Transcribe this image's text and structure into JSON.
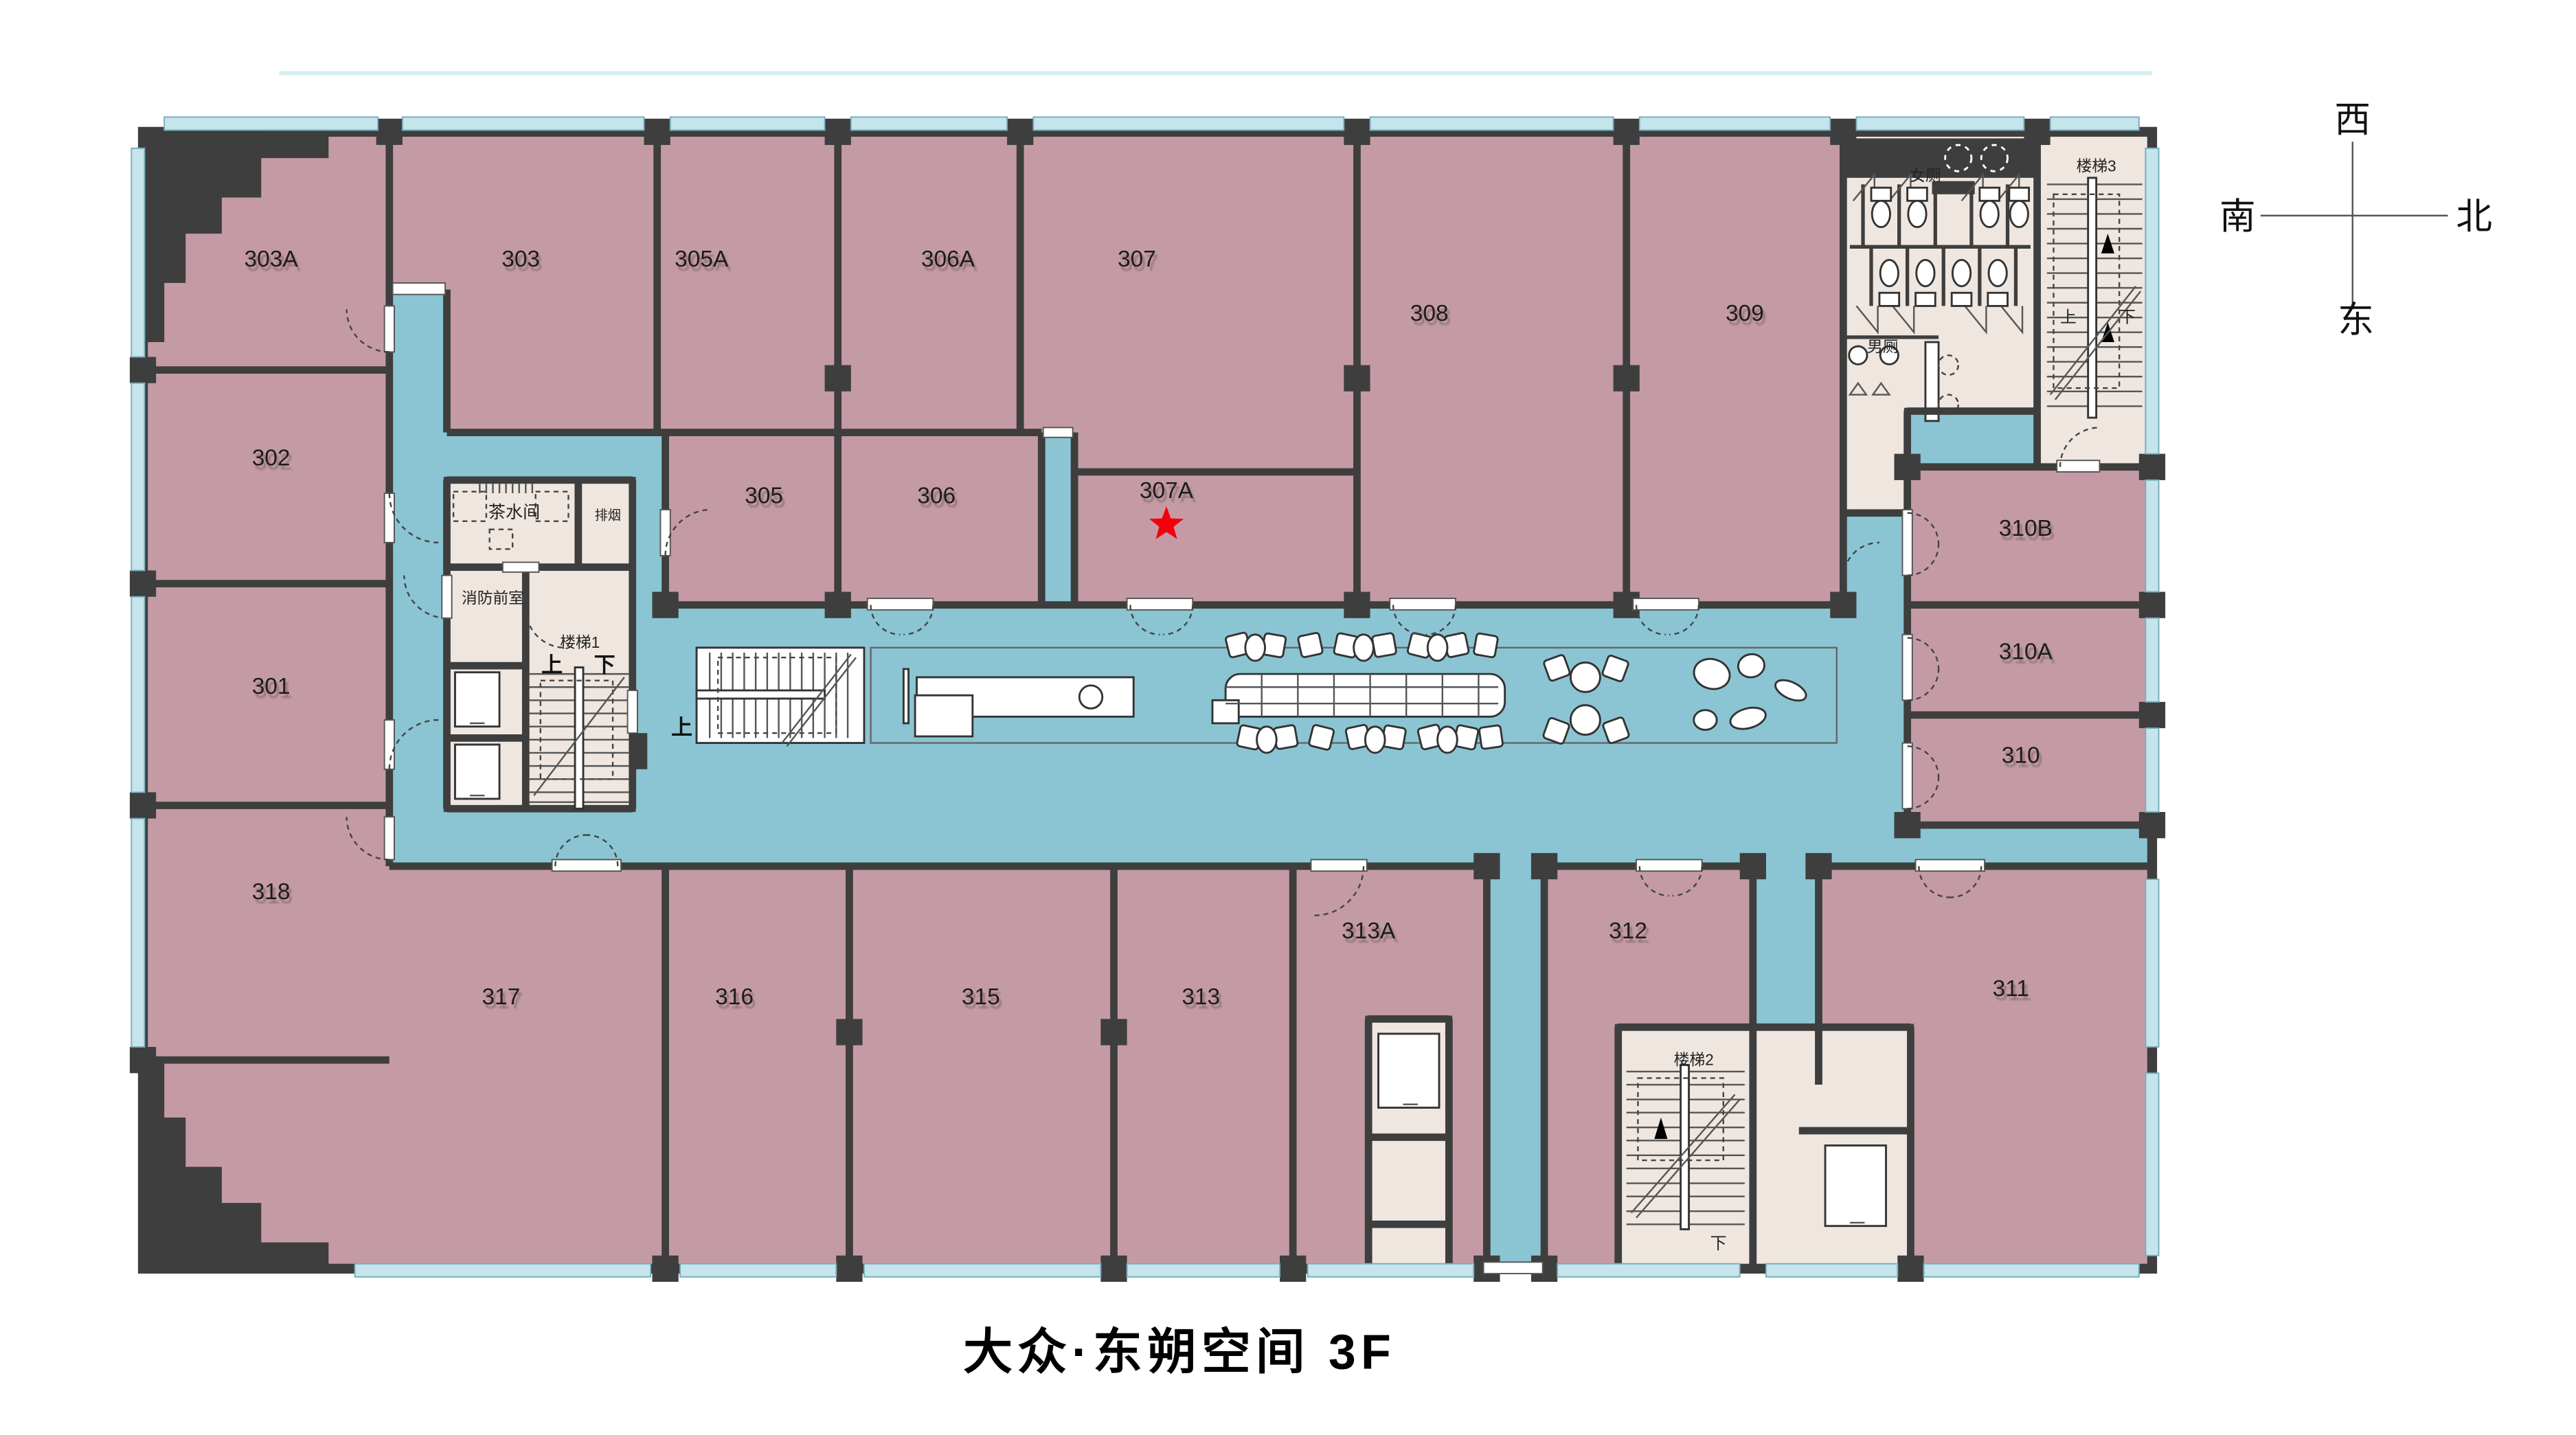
{
  "title": "大众·东朔空间 3F",
  "compass": {
    "top": "西",
    "left": "南",
    "right": "北",
    "bottom": "东"
  },
  "rooms": {
    "r303A": "303A",
    "r303": "303",
    "r305A": "305A",
    "r306A": "306A",
    "r307": "307",
    "r308": "308",
    "r309": "309",
    "r302": "302",
    "r305": "305",
    "r306": "306",
    "r307A": "307A",
    "r310B": "310B",
    "r310A": "310A",
    "r310": "310",
    "r301": "301",
    "r318": "318",
    "r317": "317",
    "r316": "316",
    "r315": "315",
    "r313": "313",
    "r313A": "313A",
    "r312": "312",
    "r311": "311"
  },
  "facilities": {
    "tea_room": "茶水间",
    "smoke_exhaust": "排烟",
    "fire_anteroom": "消防前室",
    "stairs_1": "楼梯1",
    "stairs_2": "楼梯2",
    "stairs_3": "楼梯3",
    "womens_toilet": "女厕",
    "mens_toilet": "男厕",
    "up": "上",
    "down": "下"
  },
  "marker": {
    "room": "307A",
    "shape": "red-star",
    "color": "#f2000c"
  },
  "colors": {
    "room": "#c49ba5",
    "corridor": "#8bc5d3",
    "core": "#efe6df",
    "wall": "#3e3e3e",
    "window": "#c5e4ec",
    "marker": "#f2000c"
  }
}
